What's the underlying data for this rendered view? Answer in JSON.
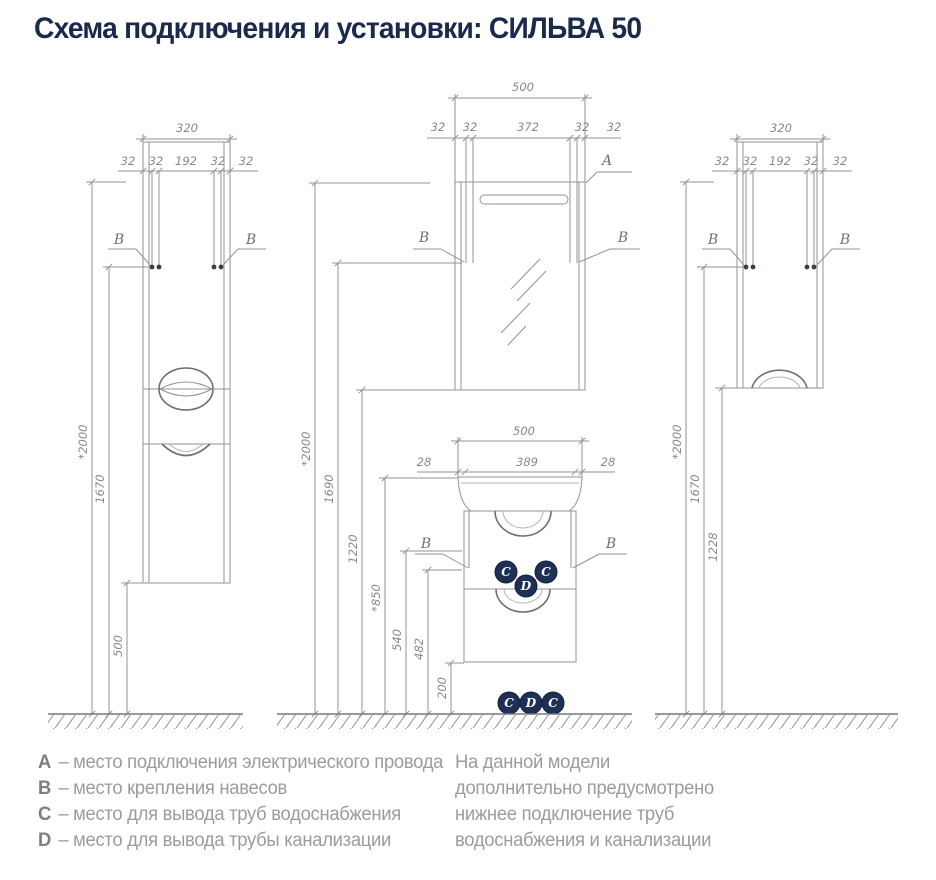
{
  "title": "Схема подключения и установки: СИЛЬВА 50",
  "colors": {
    "accent_navy": "#1b2a4c",
    "line_gray": "#8f939a",
    "text_gray": "#9b9ba1"
  },
  "markers": {
    "a": "A",
    "b": "B",
    "c": "C",
    "d": "D"
  },
  "left": {
    "w": "320",
    "row": [
      "32",
      "32",
      "192",
      "32",
      "32"
    ],
    "h2000": "*2000",
    "h1670": "1670",
    "h500": "500"
  },
  "middle": {
    "w": "500",
    "row": [
      "32",
      "32",
      "372",
      "32",
      "32"
    ],
    "h2000": "*2000",
    "h1690": "1690",
    "h1220": "1220",
    "h850": "*850",
    "h540": "540",
    "h482": "482",
    "h200": "200",
    "basin_w": "500",
    "basin_row": [
      "28",
      "389",
      "28"
    ]
  },
  "right": {
    "w": "320",
    "row": [
      "32",
      "32",
      "192",
      "32",
      "32"
    ],
    "h2000": "*2000",
    "h1670": "1670",
    "h1228": "1228"
  },
  "legend": {
    "items": [
      {
        "letter": "A",
        "text": "– место подключения электрического провода"
      },
      {
        "letter": "B",
        "text": "– место крепления навесов"
      },
      {
        "letter": "C",
        "text": "– место для вывода труб водоснабжения"
      },
      {
        "letter": "D",
        "text": "– место для вывода трубы канализации"
      }
    ]
  },
  "note": {
    "lines": [
      "На данной модели",
      "дополнительно предусмотрено",
      "нижнее подключение труб",
      "водоснабжения и канализации"
    ]
  }
}
